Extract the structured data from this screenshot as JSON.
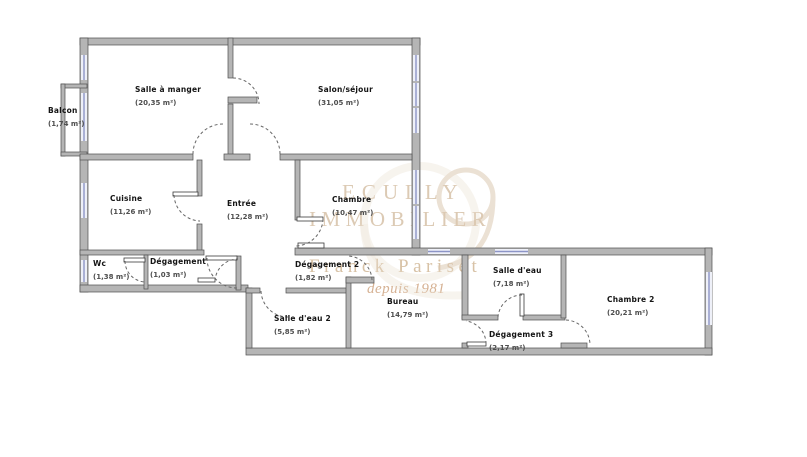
{
  "plan": {
    "title": "Apartment floor plan",
    "rooms": [
      {
        "id": "salle-a-manger",
        "name": "Salle à manger",
        "area": "(20,35 m²)"
      },
      {
        "id": "salon-sejour",
        "name": "Salon/séjour",
        "area": "(31,05 m²)"
      },
      {
        "id": "balcon",
        "name": "Balcon",
        "area": "(1,74 m²)"
      },
      {
        "id": "cuisine",
        "name": "Cuisine",
        "area": "(11,26 m²)"
      },
      {
        "id": "entree",
        "name": "Entrée",
        "area": "(12,28 m²)"
      },
      {
        "id": "chambre",
        "name": "Chambre",
        "area": "(10,47 m²)"
      },
      {
        "id": "wc",
        "name": "Wc",
        "area": "(1,38 m²)"
      },
      {
        "id": "degagement",
        "name": "Dégagement",
        "area": "(1,03 m²)"
      },
      {
        "id": "degagement-2",
        "name": "Dégagement 2",
        "area": "(1,82 m²)"
      },
      {
        "id": "salle-d-eau-2",
        "name": "Salle d'eau 2",
        "area": "(5,85 m²)"
      },
      {
        "id": "bureau",
        "name": "Bureau",
        "area": "(14,79 m²)"
      },
      {
        "id": "salle-d-eau",
        "name": "Salle d'eau",
        "area": "(7,18 m²)"
      },
      {
        "id": "degagement-3",
        "name": "Dégagement 3",
        "area": "(2,17 m²)"
      },
      {
        "id": "chambre-2",
        "name": "Chambre 2",
        "area": "(20,21 m²)"
      }
    ]
  },
  "watermark": {
    "line1": "ECULLY",
    "line2": "IMMOBILIER",
    "line3": "Franck Pariset",
    "line4": "depuis 1981"
  },
  "colors": {
    "wall": "#b5b5b5",
    "wall_outline": "#4f4f4f",
    "window_blue": "#8c94c6",
    "watermark_tan": "#dccab4",
    "watermark_accent": "#d6b294"
  }
}
